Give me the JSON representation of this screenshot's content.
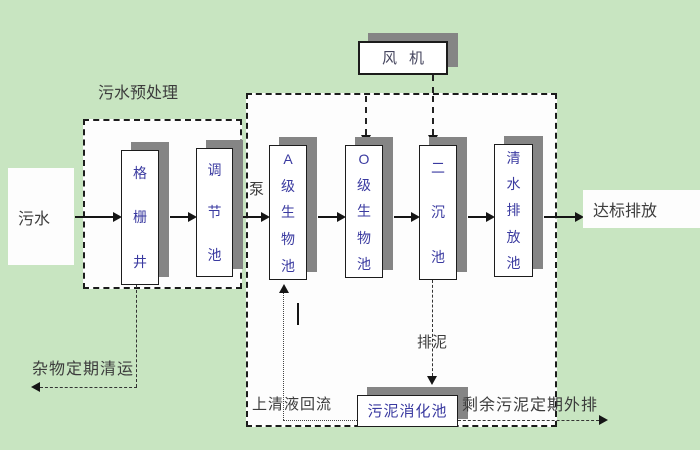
{
  "colors": {
    "background": "#c8e5c1",
    "zone_fill": "#fdfdfd",
    "box_shadow": "#858585",
    "border": "#1c1c1c",
    "tank_text_blue": "#3a3aa0",
    "label_text": "#3c3c3c"
  },
  "zones": {
    "pretreatment_label": "污水预处理"
  },
  "nodes": {
    "influent": "污水",
    "grid_well": "格栅井",
    "regulating_tank": "调节池",
    "pump": "泵",
    "a_bio_tank": "A级生物池",
    "o_bio_tank": "O级生物池",
    "secondary_clarifier": "二沉池",
    "clear_water_tank": "清水排放池",
    "effluent": "达标排放",
    "blower": "风机",
    "sludge_digester": "污泥消化池"
  },
  "flow_labels": {
    "debris_removal": "杂物定期清运",
    "supernatant_return": "上清液回流",
    "sludge_discharge": "排泥",
    "excess_sludge_out": "剩余污泥定期外排"
  }
}
